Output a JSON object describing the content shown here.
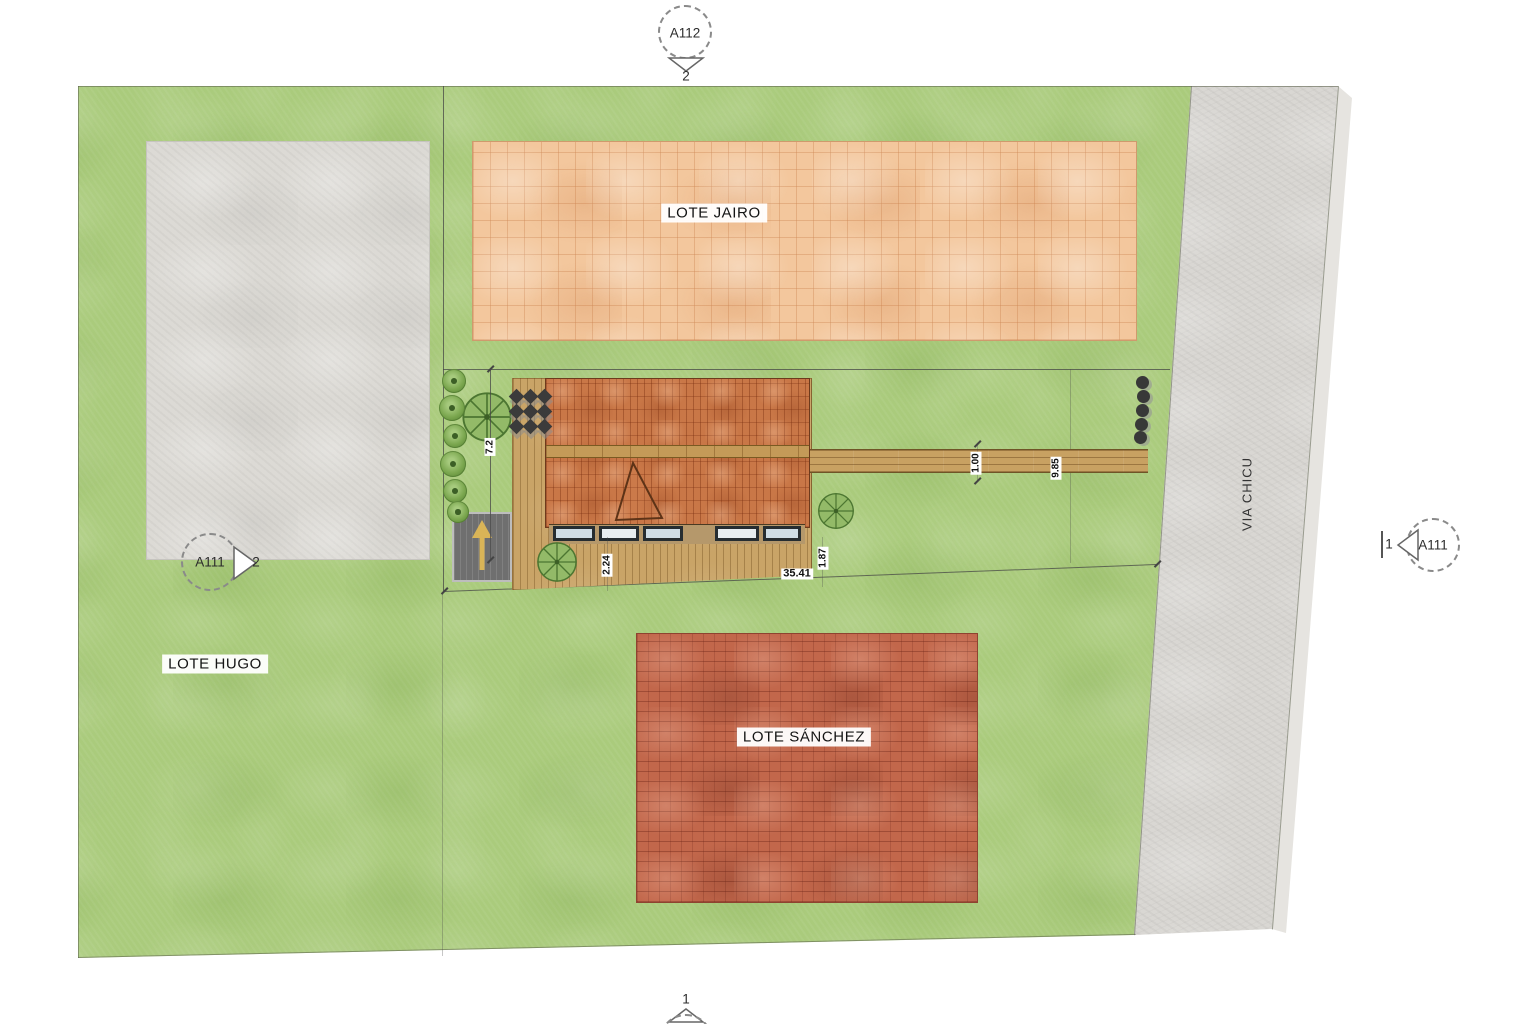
{
  "plan": {
    "lots": {
      "jairo": "LOTE JAIRO",
      "hugo": "LOTE HUGO",
      "sanchez": "LOTE SÁNCHEZ"
    },
    "road_name": "VIA CHICU",
    "dims": {
      "front_setback": "7.2",
      "deck_depth": "2.24",
      "south_boundary": "35.41",
      "deck_offset": "1.87",
      "path_width": "1.00",
      "path_length": "9.85"
    },
    "markers": {
      "top": {
        "id": "A112",
        "num": "2"
      },
      "left": {
        "id": "A111",
        "num": "2"
      },
      "right": {
        "id": "A111",
        "num": "1"
      },
      "bottom": {
        "num": "1"
      }
    },
    "colors": {
      "grass": "#aacb7c",
      "road": "#d9d7d3",
      "tile_lot": "#f3c79d",
      "brick_lot": "#c2674b",
      "roof": "#c97747",
      "wood": "#c9a467",
      "parking": "#6f6f6f",
      "arrow": "#d9b457"
    }
  }
}
